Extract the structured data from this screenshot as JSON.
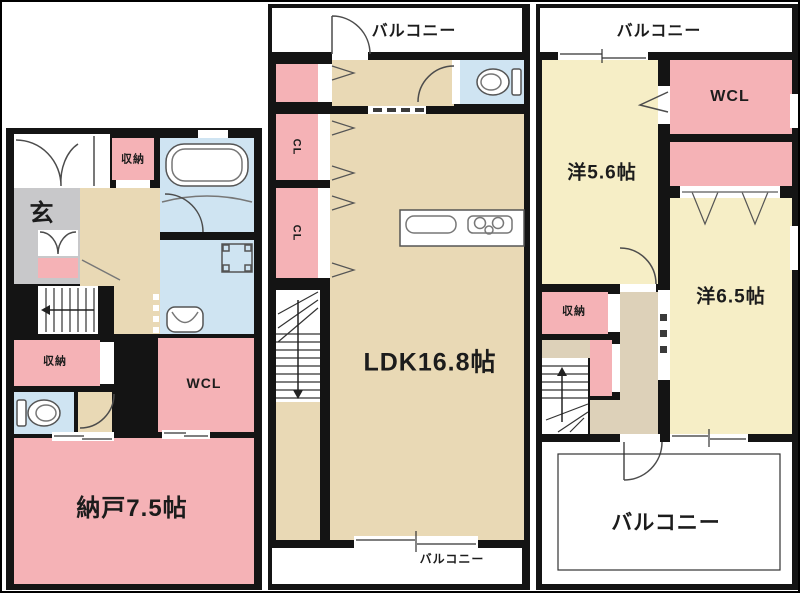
{
  "texts": {
    "f1_storage_top": "収納",
    "f1_entrance": "玄",
    "f1_storage_mid": "収納",
    "f1_wcl": "WCL",
    "f1_storage_room": "納戸7.5帖",
    "f2_balcony_top": "バルコニー",
    "f2_cl_upper": "CL",
    "f2_cl_lower": "CL",
    "f2_ldk": "LDK16.8帖",
    "f2_balcony_bottom": "バルコニー",
    "f3_balcony_top": "バルコニー",
    "f3_wcl": "WCL",
    "f3_room_5_6": "洋5.6帖",
    "f3_room_6_5": "洋6.5帖",
    "f3_storage": "収納",
    "f3_balcony_bottom": "バルコニー"
  },
  "colors": {
    "wall": "#141414",
    "room_pink": "#f5b2b6",
    "room_tan": "#e9d9b5",
    "room_cream": "#f6eec6",
    "wet_area_blue": "#cfe4f2",
    "entrance_gray": "#c8c8ca",
    "hall_beige": "#ddd1b9",
    "background": "#ffffff"
  },
  "fixtures": [
    "bathtub",
    "washbasin",
    "washing-machine-pan",
    "toilet",
    "kitchen-counter",
    "kitchen-sink",
    "stove",
    "stairs",
    "door-swing",
    "sliding-door",
    "double-door",
    "closet-hanger-marks"
  ]
}
